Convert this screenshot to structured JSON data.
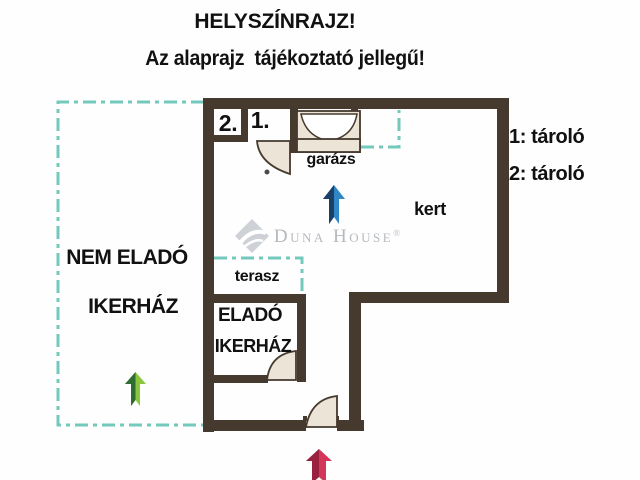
{
  "header": {
    "title": "HELYSZÍNRAJZ!",
    "subtitle": "Az alaprajz  tájékoztató jellegű!"
  },
  "legend": {
    "item1": "1: tároló",
    "item2": "2: tároló"
  },
  "plan": {
    "room1_label": "1.",
    "room2_label": "2.",
    "garage_label": "garázs",
    "garden_label": "kert",
    "terrace_label": "terasz",
    "not_for_sale_line1": "NEM ELADÓ",
    "not_for_sale_line2": "IKERHÁZ",
    "for_sale_line1": "ELADÓ",
    "for_sale_line2": "IKERHÁZ"
  },
  "watermark": {
    "brand": "Duna House",
    "registered": "®"
  },
  "icons": {
    "blue_arrow": "arrow-up",
    "green_arrow": "arrow-up",
    "red_arrow": "arrow-up",
    "doors": "door-swing-arc",
    "logo": "duna-house-diamond"
  },
  "colors": {
    "text": "#111111",
    "wall": "#46392e",
    "dash": "#74c9bd",
    "door_fill": "#ece4d6",
    "watermark": "#b6b9be",
    "diamond": "#ced1d5",
    "arrow_blue_dark": "#1b3f66",
    "arrow_blue_light": "#2f87c5",
    "arrow_green_dark": "#2f6c31",
    "arrow_green_light": "#8cc63f",
    "arrow_red_dark": "#9a2040",
    "arrow_red_light": "#d2375a"
  }
}
